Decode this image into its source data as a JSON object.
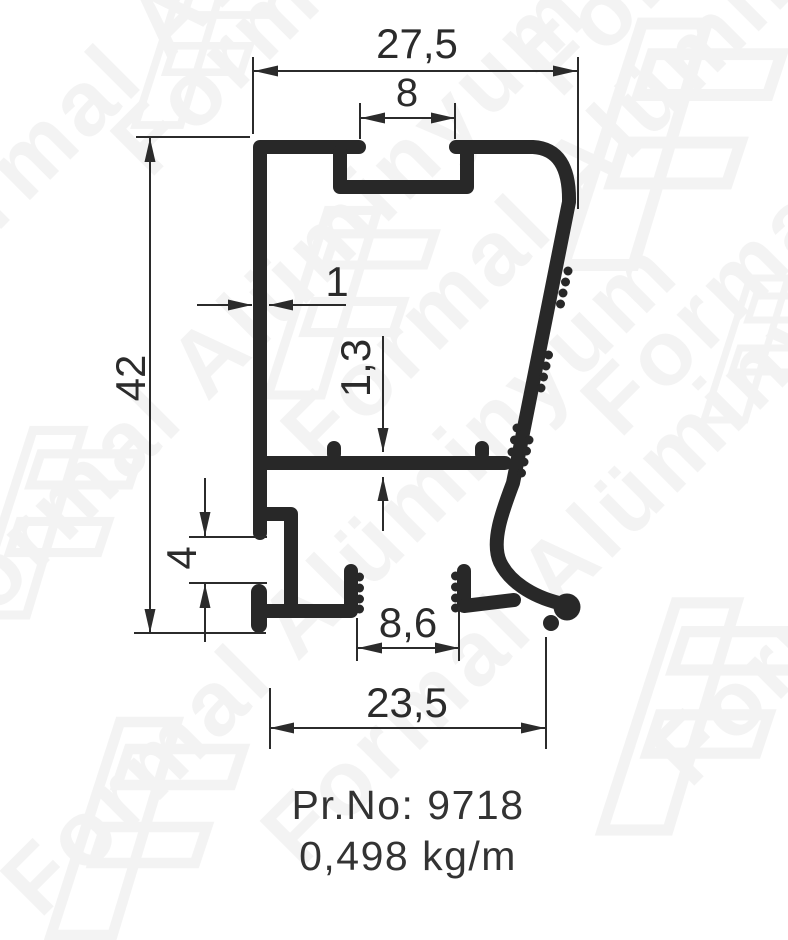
{
  "drawing": {
    "product_no_label": "Pr.No: 9718",
    "weight_label": "0,498 kg/m"
  },
  "dimensions": {
    "overall_width": "27,5",
    "slot_opening": "8",
    "overall_height": "42",
    "wall_thickness": "1",
    "web_thickness": "1,3",
    "side_groove_opening": "4",
    "bottom_channel_opening": "8,6",
    "bottom_width": "23,5"
  },
  "watermark": {
    "text": "Formal Alüminyum"
  },
  "colors": {
    "profile_line": "#282828",
    "dimension_line": "#2b2b2b",
    "background": "#ffffff",
    "watermark_tint": "#3a3a3a"
  }
}
